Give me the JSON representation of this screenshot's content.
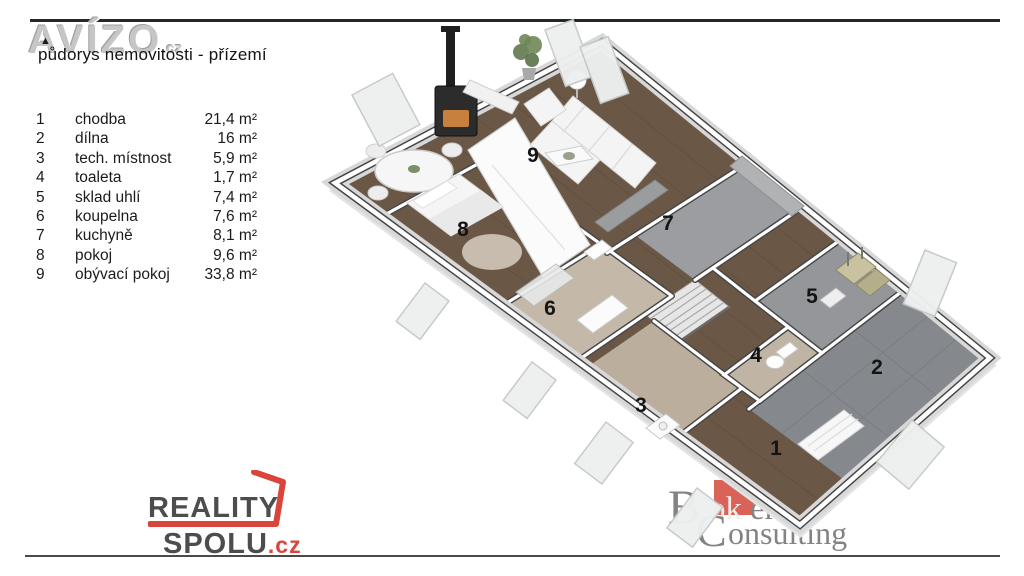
{
  "header": {
    "watermark": "AVÍZO",
    "watermark_suffix": ".cz",
    "subtitle": "půdorys nemovitosti - přízemí"
  },
  "legend": {
    "rows": [
      {
        "num": "1",
        "name": "chodba",
        "area": "21,4 m²"
      },
      {
        "num": "2",
        "name": "dílna",
        "area": "16 m²"
      },
      {
        "num": "3",
        "name": "tech. místnost",
        "area": "5,9 m²"
      },
      {
        "num": "4",
        "name": "toaleta",
        "area": "1,7 m²"
      },
      {
        "num": "5",
        "name": "sklad uhlí",
        "area": "7,4 m²"
      },
      {
        "num": "6",
        "name": "koupelna",
        "area": "7,6 m²"
      },
      {
        "num": "7",
        "name": "kuchyně",
        "area": "8,1 m²"
      },
      {
        "num": "8",
        "name": "pokoj",
        "area": "9,6 m²"
      },
      {
        "num": "9",
        "name": "obývací pokoj",
        "area": "33,8 m²"
      }
    ]
  },
  "floorplan": {
    "room_labels": [
      "1",
      "2",
      "3",
      "4",
      "5",
      "6",
      "7",
      "8",
      "9"
    ]
  },
  "footer": {
    "reality": {
      "top": "REALITY",
      "bottom": "SPOLU",
      "tld": ".cz"
    },
    "broker": {
      "b": "B",
      "rok": "rok",
      "er": "er",
      "reg": "®",
      "c": "C",
      "onsulting": "onsulting"
    }
  },
  "colors": {
    "accent_red": "#d9453a",
    "broker_red": "#d4483c",
    "wall_line": "#454545",
    "wood_floor": "#6b5746",
    "tile_gray": "#85888d",
    "tile_beige": "#beb2a2"
  }
}
